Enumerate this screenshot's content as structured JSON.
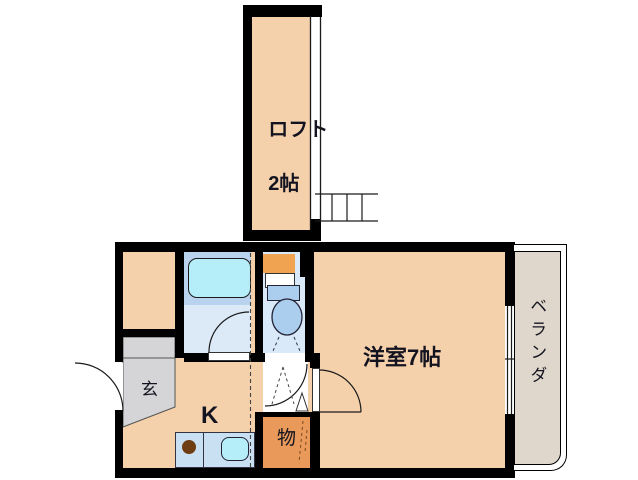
{
  "plan_title": "1K apartment floor plan with loft",
  "rooms": {
    "loft": {
      "label": "ロフト",
      "size": "2帖"
    },
    "main_room": {
      "label": "洋室7帖"
    },
    "kitchen": {
      "label": "K"
    },
    "entrance": {
      "label": "玄"
    },
    "storage": {
      "label": "物"
    },
    "veranda": {
      "label": "ベランダ"
    }
  },
  "fixtures": {
    "bathtub": "bathtub",
    "toilet": "toilet",
    "sink": "kitchen-sink",
    "burner": "single-burner",
    "ladder": "loft-ladder",
    "window": "sliding-window"
  },
  "colors": {
    "floor_peach": "#F4D0AB",
    "entrance_gray": "#D5D5D7",
    "veranda_tan": "#DFD7CC",
    "bath_upper": "#B9D2EE",
    "bath_lower": "#DCE9F7",
    "bathtub": "#B5EEF8",
    "toilet_room": "#D9E9F9",
    "toilet_fixture": "#ABCDEE",
    "shelf_orange": "#F0A351",
    "storage_orange": "#E99959",
    "counter_blue": "#C9E0F2",
    "sink_cyan": "#B5EEF8",
    "burner_brown": "#6F3D12",
    "wall": "#000000"
  }
}
